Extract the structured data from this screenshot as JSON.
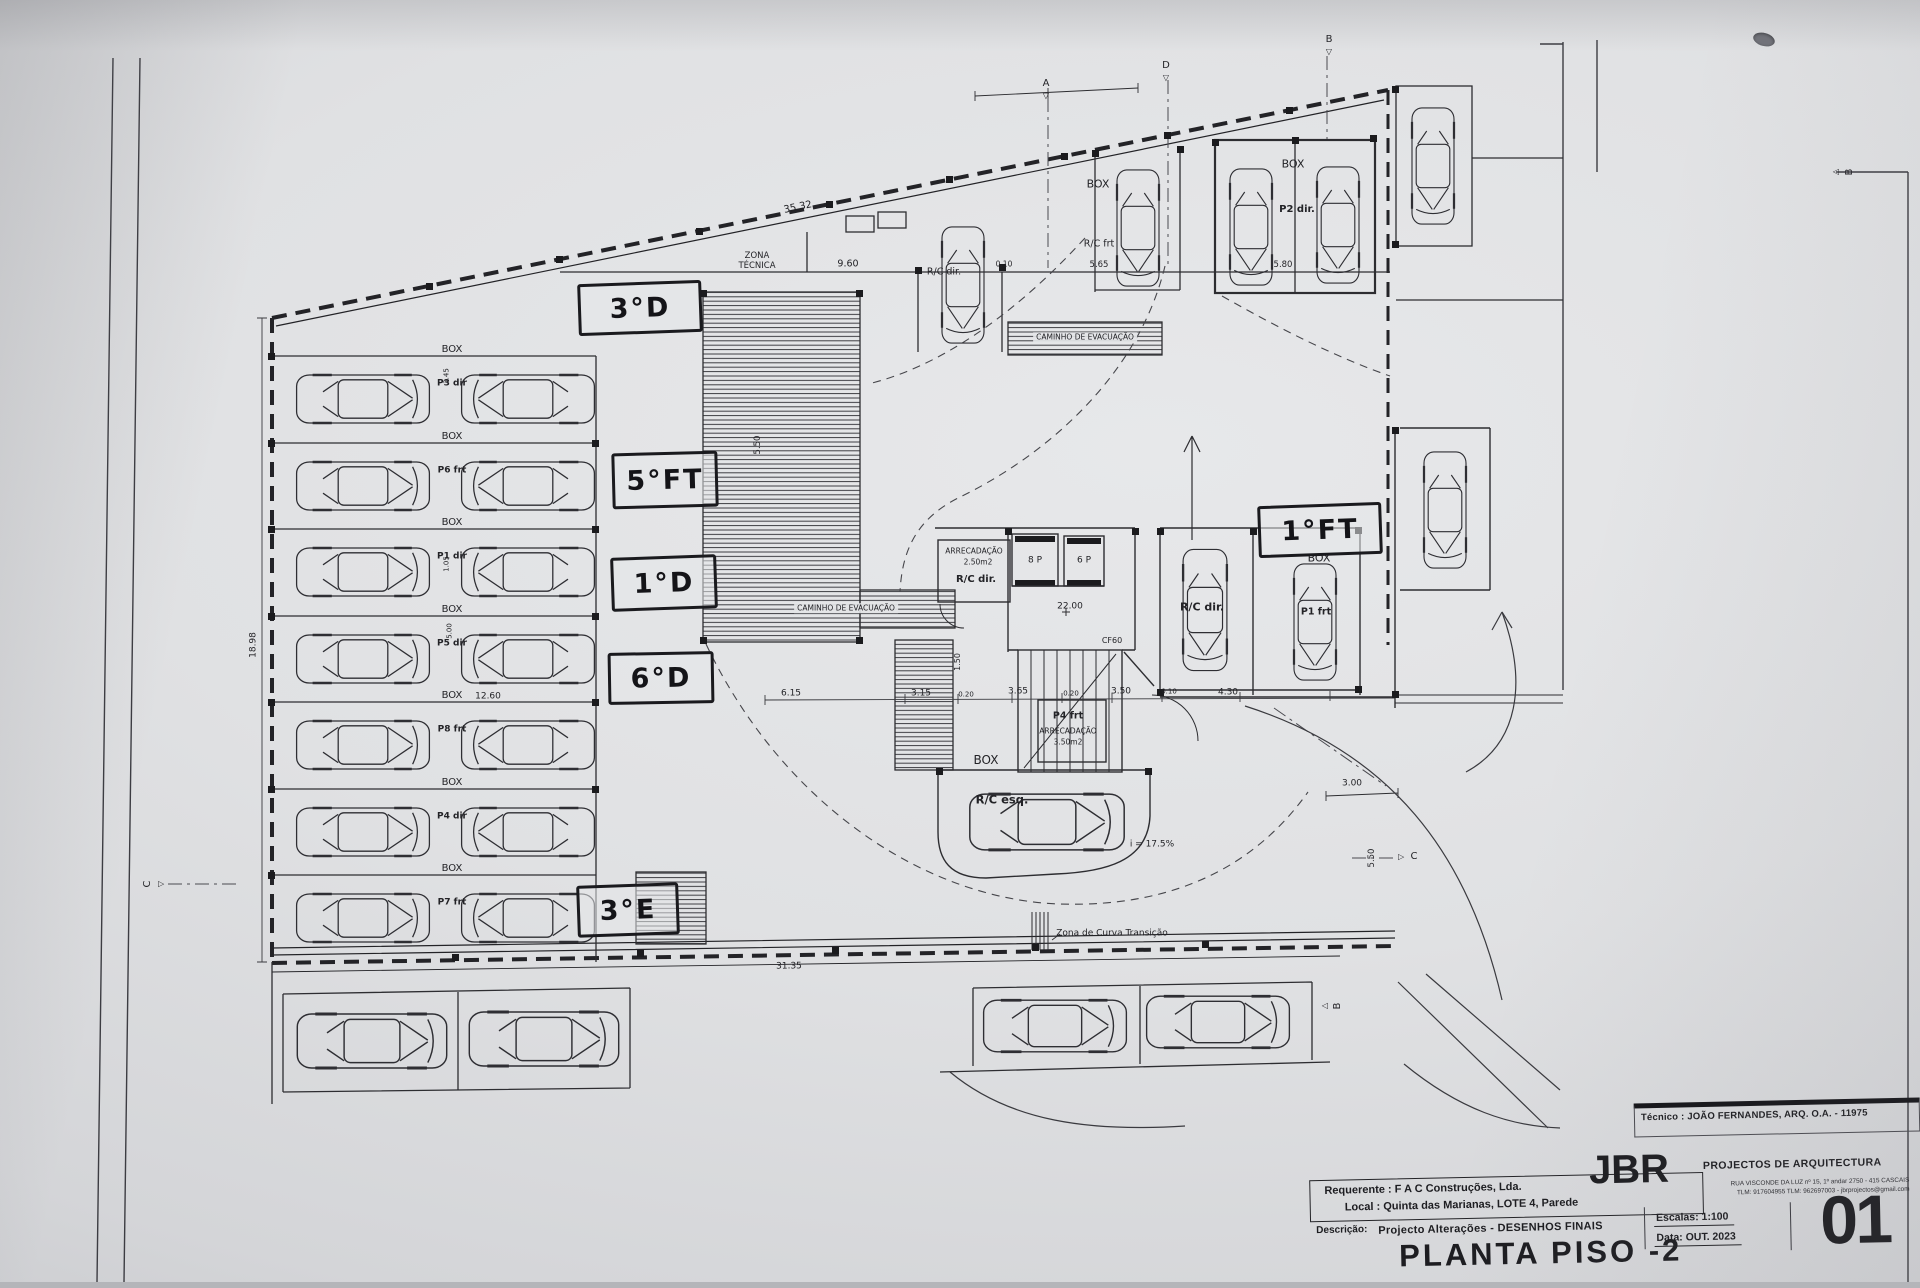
{
  "sheet": {
    "tecnico": "Técnico : JOÃO FERNANDES, ARQ.   O.A. - 11975",
    "requerente": "Requerente : F A C  Construções, Lda.",
    "local": "Local : Quinta das Marianas, LOTE 4, Parede",
    "descricao_label": "Descrição:",
    "descricao": "Projecto Alterações - DESENHOS FINAIS",
    "title": "PLANTA PISO -2",
    "firm_name": "JBR",
    "firm_tagline": "PROJECTOS DE ARQUITECTURA",
    "firm_address_line1": "RUA VISCONDE DA LUZ nº 15, 1º andar  2750 - 415  CASCAIS",
    "firm_address_line2": "TLM: 917604955  TLM: 962697003 - jbrprojectos@gmail.com",
    "escala": "Escalas:  1:100",
    "data": "Data: OUT.  2023",
    "sheet_number": "01"
  },
  "colors": {
    "ink": "#2b2b2f",
    "hand_ink": "#1a1a1e",
    "paper": "#e0e1e3"
  },
  "handwritten_labels": [
    {
      "n": "handwritten-3d",
      "t": "3°D",
      "x": 578,
      "y": 282,
      "w": 118,
      "h": 46,
      "r": -2
    },
    {
      "n": "handwritten-5ft",
      "t": "5°FT",
      "x": 612,
      "y": 452,
      "w": 100,
      "h": 50,
      "r": -1.5
    },
    {
      "n": "handwritten-1d",
      "t": "1°D",
      "x": 611,
      "y": 556,
      "w": 100,
      "h": 48,
      "r": -2
    },
    {
      "n": "handwritten-6d",
      "t": "6°D",
      "x": 608,
      "y": 652,
      "w": 100,
      "h": 46,
      "r": -1
    },
    {
      "n": "handwritten-3e",
      "t": "3°E",
      "x": 577,
      "y": 884,
      "w": 96,
      "h": 46,
      "r": -2
    },
    {
      "n": "handwritten-1ft",
      "t": "1°FT",
      "x": 1258,
      "y": 504,
      "w": 118,
      "h": 46,
      "r": -2
    }
  ],
  "annotations": [
    {
      "n": "zona-tecnica-line1",
      "t": "ZONA",
      "x": 757,
      "y": 256,
      "s": 8.5
    },
    {
      "n": "zona-tecnica-line2",
      "t": "TÉCNICA",
      "x": 757,
      "y": 266,
      "s": 8.5
    },
    {
      "n": "dim-top-slant",
      "t": "35.32",
      "x": 798,
      "y": 208,
      "s": 10,
      "r": -11.5
    },
    {
      "n": "dim-9-60",
      "t": "9.60",
      "x": 848,
      "y": 264,
      "s": 9.5
    },
    {
      "n": "dim-0-10-top",
      "t": "0.10",
      "x": 1004,
      "y": 264,
      "s": 7.5
    },
    {
      "n": "dim-5-65",
      "t": "5.65",
      "x": 1099,
      "y": 265,
      "s": 8.5
    },
    {
      "n": "dim-5-80",
      "t": "5.80",
      "x": 1283,
      "y": 265,
      "s": 8.5
    },
    {
      "n": "box-label-rc-frt",
      "t": "BOX",
      "x": 1098,
      "y": 184,
      "s": 11
    },
    {
      "n": "stall-rc-frt",
      "t": "R/C frt",
      "x": 1099,
      "y": 244,
      "s": 9.5
    },
    {
      "n": "box-label-p2",
      "t": "BOX",
      "x": 1293,
      "y": 164,
      "s": 11
    },
    {
      "n": "stall-p2-dir",
      "t": "P2 dir.",
      "x": 1297,
      "y": 210,
      "s": 10,
      "b": 1
    },
    {
      "n": "stall-rc-dir-top",
      "t": "R/C dir.",
      "x": 944,
      "y": 272,
      "s": 9.5
    },
    {
      "n": "caminho-evacuacao-top",
      "t": "CAMINHO DE EVACUAÇÃO",
      "x": 1085,
      "y": 337,
      "s": 7.5,
      "bg": 1
    },
    {
      "n": "caminho-evacuacao-left",
      "t": "CAMINHO DE EVACUAÇÃO",
      "x": 846,
      "y": 608,
      "s": 7.5,
      "bg": 1
    },
    {
      "n": "arrecadacao-1",
      "t": "ARRECADAÇÃO",
      "x": 974,
      "y": 551,
      "s": 7.5
    },
    {
      "n": "arrecadacao-1-area",
      "t": "2.50m2",
      "x": 978,
      "y": 562,
      "s": 7.5
    },
    {
      "n": "stall-rc-dir-store",
      "t": "R/C dir.",
      "x": 976,
      "y": 580,
      "s": 10,
      "b": 1
    },
    {
      "n": "elevator-8p",
      "t": "8 P",
      "x": 1035,
      "y": 561,
      "s": 9
    },
    {
      "n": "elevator-6p",
      "t": "6 P",
      "x": 1084,
      "y": 561,
      "s": 9
    },
    {
      "n": "level-marker",
      "t": "22.00",
      "x": 1070,
      "y": 607,
      "s": 9
    },
    {
      "n": "door-cf60",
      "t": "CF60",
      "x": 1112,
      "y": 641,
      "s": 8
    },
    {
      "n": "dim-1-50",
      "t": "1.50",
      "x": 958,
      "y": 662,
      "s": 8,
      "r": -90
    },
    {
      "n": "stall-p4-frt",
      "t": "P4 frt",
      "x": 1068,
      "y": 716,
      "s": 9.5,
      "b": 1
    },
    {
      "n": "arrecadacao-2",
      "t": "ARRECADAÇÃO",
      "x": 1068,
      "y": 731,
      "s": 7.5
    },
    {
      "n": "arrecadacao-2-area",
      "t": "3.50m2",
      "x": 1068,
      "y": 742,
      "s": 7.5
    },
    {
      "n": "stall-rc-dir-car",
      "t": "R/C dir.",
      "x": 1202,
      "y": 607,
      "s": 11,
      "b": 1
    },
    {
      "n": "box-label-p1",
      "t": "BOX",
      "x": 1319,
      "y": 558,
      "s": 11
    },
    {
      "n": "stall-p1-frt",
      "t": "P1 frt",
      "x": 1316,
      "y": 612,
      "s": 9.5,
      "b": 1
    },
    {
      "n": "box-label-rc-esq",
      "t": "BOX",
      "x": 986,
      "y": 760,
      "s": 12
    },
    {
      "n": "stall-rc-esq",
      "t": "R/C esq.",
      "x": 1002,
      "y": 800,
      "s": 11.5,
      "b": 1
    },
    {
      "n": "ramp-slope",
      "t": "i = 17.5%",
      "x": 1152,
      "y": 845,
      "s": 9
    },
    {
      "n": "zona-curva-transicao",
      "t": "Zona de Curva Transição",
      "x": 1112,
      "y": 934,
      "s": 9
    },
    {
      "n": "dim-31-35",
      "t": "31.35",
      "x": 789,
      "y": 967,
      "s": 9,
      "r": -0.8
    },
    {
      "n": "dim-6-15",
      "t": "6.15",
      "x": 791,
      "y": 694,
      "s": 9
    },
    {
      "n": "dim-3-15",
      "t": "3.15",
      "x": 921,
      "y": 694,
      "s": 9
    },
    {
      "n": "dim-0-20-a",
      "t": "0.20",
      "x": 966,
      "y": 695,
      "s": 7
    },
    {
      "n": "dim-3-65",
      "t": "3.65",
      "x": 1018,
      "y": 692,
      "s": 9
    },
    {
      "n": "dim-0-20-b",
      "t": "0.20",
      "x": 1071,
      "y": 694,
      "s": 7
    },
    {
      "n": "dim-3-50",
      "t": "3.50",
      "x": 1121,
      "y": 692,
      "s": 9
    },
    {
      "n": "dim-0-10-b",
      "t": "0.10",
      "x": 1169,
      "y": 692,
      "s": 7
    },
    {
      "n": "dim-4-30",
      "t": "4.30",
      "x": 1228,
      "y": 693,
      "s": 9
    },
    {
      "n": "dim-12-60",
      "t": "12.60",
      "x": 488,
      "y": 697,
      "s": 9
    },
    {
      "n": "dim-18-98",
      "t": "18.98",
      "x": 254,
      "y": 645,
      "s": 9,
      "r": -90
    },
    {
      "n": "dim-3-00",
      "t": "3.00",
      "x": 1352,
      "y": 784,
      "s": 9
    },
    {
      "n": "dim-5-50-right",
      "t": "5.50",
      "x": 1372,
      "y": 858,
      "s": 8.5,
      "r": -90
    },
    {
      "n": "dim-5-50-ramp",
      "t": "5.50",
      "x": 758,
      "y": 445,
      "s": 8.5,
      "r": -90
    },
    {
      "n": "box-row-1",
      "t": "BOX",
      "x": 452,
      "y": 350,
      "s": 10
    },
    {
      "n": "box-row-2",
      "t": "BOX",
      "x": 452,
      "y": 437,
      "s": 10
    },
    {
      "n": "box-row-3",
      "t": "BOX",
      "x": 452,
      "y": 523,
      "s": 10
    },
    {
      "n": "box-row-4",
      "t": "BOX",
      "x": 452,
      "y": 610,
      "s": 10
    },
    {
      "n": "box-row-5",
      "t": "BOX",
      "x": 452,
      "y": 696,
      "s": 10
    },
    {
      "n": "box-row-6",
      "t": "BOX",
      "x": 452,
      "y": 783,
      "s": 10
    },
    {
      "n": "box-row-7",
      "t": "BOX",
      "x": 452,
      "y": 869,
      "s": 10
    },
    {
      "n": "stall-row-1",
      "t": "P3 dir",
      "x": 452,
      "y": 384,
      "s": 9,
      "b": 1
    },
    {
      "n": "stall-row-2",
      "t": "P6 frt",
      "x": 452,
      "y": 471,
      "s": 9,
      "b": 1
    },
    {
      "n": "stall-row-3",
      "t": "P1 dir",
      "x": 452,
      "y": 557,
      "s": 9,
      "b": 1
    },
    {
      "n": "stall-row-4",
      "t": "P5 dir",
      "x": 452,
      "y": 644,
      "s": 9,
      "b": 1
    },
    {
      "n": "stall-row-5",
      "t": "P8 frt",
      "x": 452,
      "y": 730,
      "s": 9,
      "b": 1
    },
    {
      "n": "stall-row-6",
      "t": "P4 dir",
      "x": 452,
      "y": 817,
      "s": 9,
      "b": 1
    },
    {
      "n": "stall-row-7",
      "t": "P7 frt",
      "x": 452,
      "y": 903,
      "s": 9,
      "b": 1
    },
    {
      "n": "dim-3-45",
      "t": "3.45",
      "x": 447,
      "y": 376,
      "s": 7,
      "r": -90
    },
    {
      "n": "dim-1-05",
      "t": "1.05",
      "x": 447,
      "y": 564,
      "s": 7,
      "r": -90
    },
    {
      "n": "dim-5-00",
      "t": "5.00",
      "x": 450,
      "y": 631,
      "s": 7,
      "r": -90
    },
    {
      "n": "section-marker-a",
      "t": "A",
      "x": 1046,
      "y": 84,
      "s": 10
    },
    {
      "n": "section-marker-a-arrow",
      "t": "◁",
      "x": 1046,
      "y": 96,
      "s": 8,
      "r": -90
    },
    {
      "n": "section-marker-d",
      "t": "D",
      "x": 1166,
      "y": 66,
      "s": 10
    },
    {
      "n": "section-marker-d-arrow",
      "t": "◁",
      "x": 1166,
      "y": 78,
      "s": 8,
      "r": -90
    },
    {
      "n": "section-marker-b-top",
      "t": "B",
      "x": 1329,
      "y": 40,
      "s": 10
    },
    {
      "n": "section-marker-b-top-arrow",
      "t": "◁",
      "x": 1329,
      "y": 52,
      "s": 8,
      "r": -90
    },
    {
      "n": "section-marker-b-right",
      "t": "B",
      "x": 1850,
      "y": 172,
      "s": 10,
      "r": -90
    },
    {
      "n": "section-marker-b-right-arrow",
      "t": "◁",
      "x": 1836,
      "y": 172,
      "s": 8
    },
    {
      "n": "section-marker-c-left",
      "t": "C",
      "x": 148,
      "y": 884,
      "s": 10,
      "r": -90
    },
    {
      "n": "section-marker-c-left-arrow",
      "t": "◁",
      "x": 161,
      "y": 884,
      "s": 8,
      "r": 180
    },
    {
      "n": "section-marker-c-right",
      "t": "C",
      "x": 1414,
      "y": 857,
      "s": 10
    },
    {
      "n": "section-marker-c-right-arrow",
      "t": "◁",
      "x": 1401,
      "y": 857,
      "s": 8,
      "r": 180
    },
    {
      "n": "section-marker-b-bottom",
      "t": "B",
      "x": 1338,
      "y": 1006,
      "s": 10,
      "r": -90
    },
    {
      "n": "section-marker-b-bottom-arrow",
      "t": "◁",
      "x": 1325,
      "y": 1006,
      "s": 8
    }
  ]
}
